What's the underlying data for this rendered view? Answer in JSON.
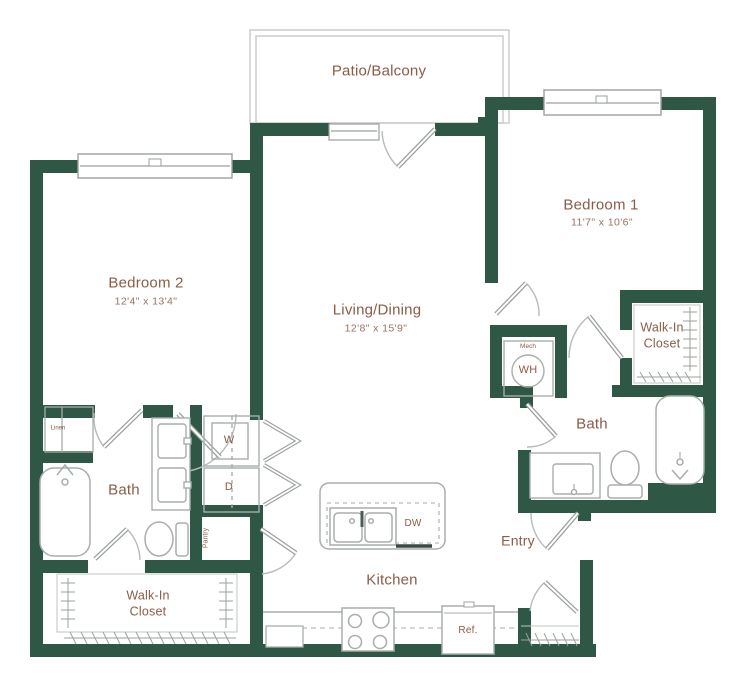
{
  "colors": {
    "wall": "#2e5745",
    "room_label": "#8a5c46",
    "dim_label": "#9b7260",
    "fixture_line": "#a8adab"
  },
  "rooms": {
    "patio": {
      "name": "Patio/Balcony"
    },
    "bedroom1": {
      "name": "Bedroom 1",
      "dims": "11'7\" x 10'6\""
    },
    "bedroom2": {
      "name": "Bedroom 2",
      "dims": "12'4\" x 13'4\""
    },
    "living": {
      "name": "Living/Dining",
      "dims": "12'8\" x 15'9\""
    },
    "kitchen": {
      "name": "Kitchen"
    },
    "entry": {
      "name": "Entry"
    },
    "bath_main": {
      "name": "Bath"
    },
    "bath_second": {
      "name": "Bath"
    },
    "walkin_main": {
      "name": "Walk-In\nCloset"
    },
    "walkin_second": {
      "name": "Walk-In\nCloset"
    }
  },
  "fixtures": {
    "washer": "W",
    "dryer": "D",
    "water_heater": "WH",
    "mech": "Mech",
    "dishwasher": "DW",
    "refrigerator": "Ref.",
    "pantry": "Pantry",
    "linen": "Linen"
  }
}
